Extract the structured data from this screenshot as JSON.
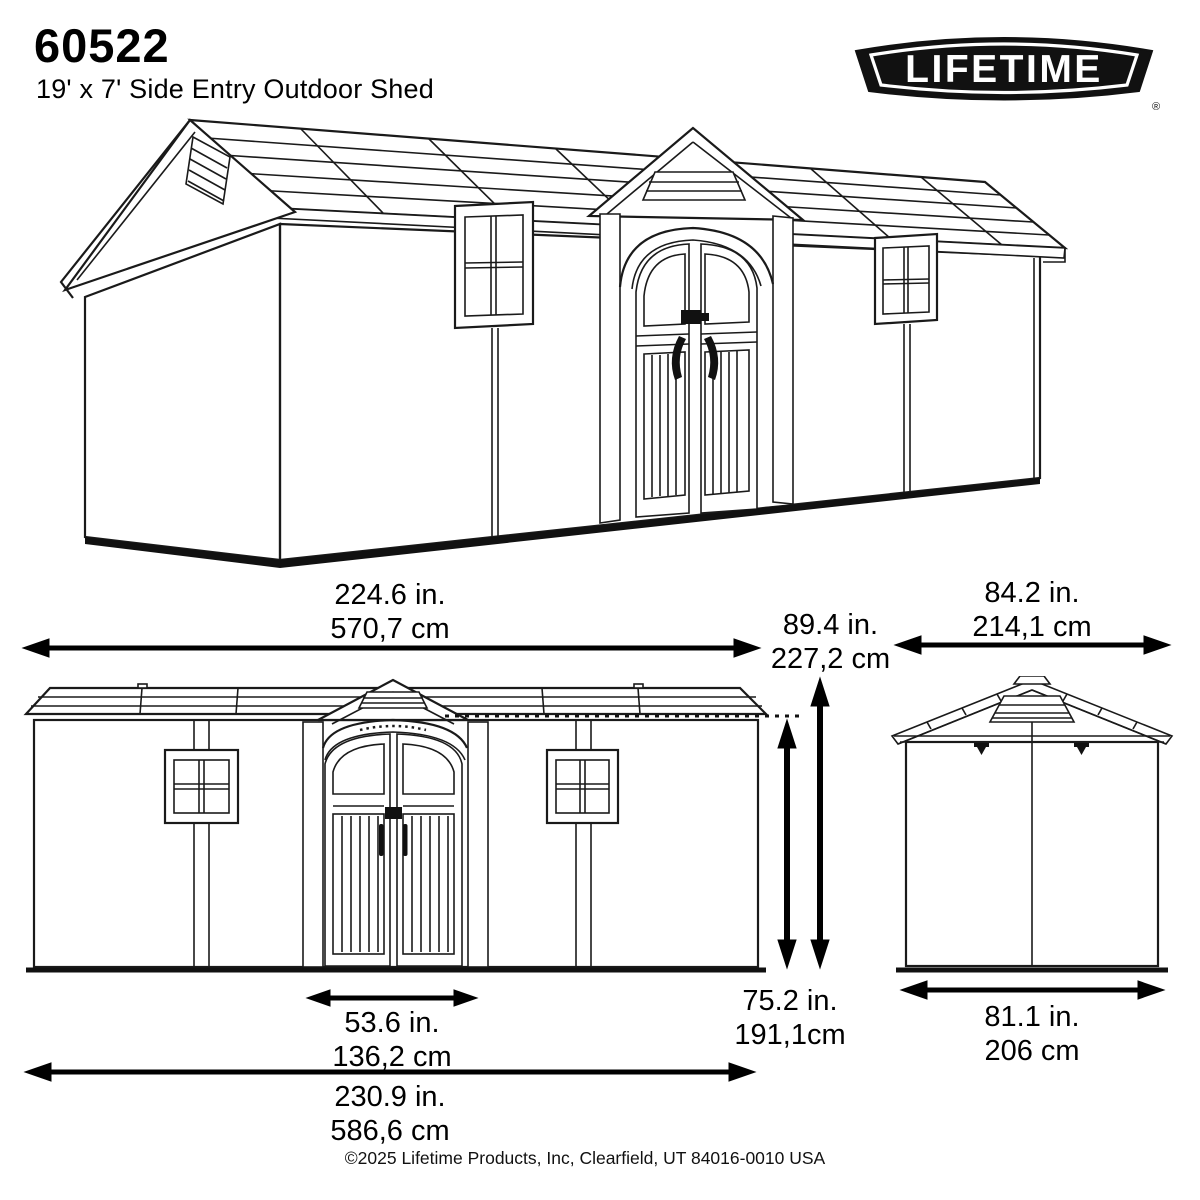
{
  "header": {
    "model_number": "60522",
    "product_name": "19' x 7' Side Entry Outdoor Shed",
    "brand": "LIFETIME",
    "registered_mark": "®"
  },
  "dimensions": {
    "overall_width": {
      "in": "224.6 in.",
      "cm": "570,7 cm"
    },
    "peak_height": {
      "in": "89.4 in.",
      "cm": "227,2 cm"
    },
    "side_width": {
      "in": "84.2 in.",
      "cm": "214,1 cm"
    },
    "eave_height": {
      "in": "75.2 in.",
      "cm": "191,1cm"
    },
    "door_width": {
      "in": "53.6 in.",
      "cm": "136,2 cm"
    },
    "total_width": {
      "in": "230.9 in.",
      "cm": "586,6 cm"
    },
    "side_base_width": {
      "in": "81.1 in.",
      "cm": "206 cm"
    }
  },
  "footer": {
    "copyright": "©2025 Lifetime Products, Inc, Clearfield, UT 84016-0010 USA"
  },
  "colors": {
    "ink": "#000000",
    "line": "#1a1a1a",
    "background": "#ffffff"
  }
}
